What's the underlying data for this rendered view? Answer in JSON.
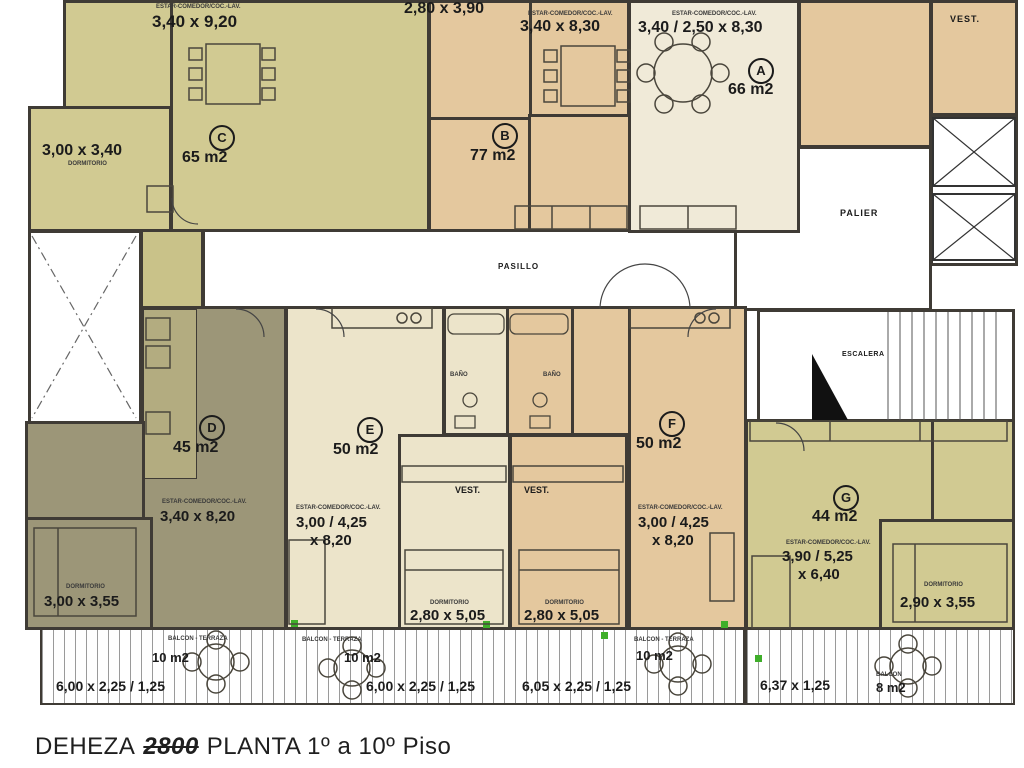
{
  "title": {
    "street": "DEHEZA",
    "number": "2800",
    "rest": "PLANTA 1º a 10º Piso"
  },
  "units": [
    {
      "letter": "A",
      "area": "66 m2",
      "living": "3,40 / 2,50 x 8,30"
    },
    {
      "letter": "B",
      "area": "77 m2",
      "living": "3,40 x 8,30",
      "bedroom": "2,80 x 3,90"
    },
    {
      "letter": "C",
      "area": "65 m2",
      "living": "3,40 x 9,20",
      "bedroom": "3,00 x 3,40"
    },
    {
      "letter": "D",
      "area": "45 m2",
      "living": "3,40 x 8,20",
      "bedroom": "3,00 x 3,55"
    },
    {
      "letter": "E",
      "area": "50 m2",
      "living1": "3,00 / 4,25",
      "living2": "x 8,20",
      "bedroom": "2,80 x 5,05"
    },
    {
      "letter": "F",
      "area": "50 m2",
      "living1": "3,00 / 4,25",
      "living2": "x 8,20",
      "bedroom": "2,80 x 5,05"
    },
    {
      "letter": "G",
      "area": "44 m2",
      "living1": "3,90 / 5,25",
      "living2": "x 6,40",
      "bedroom": "2,90 x 3,55"
    }
  ],
  "common": {
    "pasillo": "PASILLO",
    "palier": "PALIER",
    "escalera": "ESCALERA",
    "vest": "VEST.",
    "bano": "BAÑO",
    "dormitorio": "DORMITORIO",
    "estar": "ESTAR-COMEDOR/COC.-LAV.",
    "balcon_terraza": "BALCON - TERRAZA",
    "balcon": "BALCON"
  },
  "balconies": [
    {
      "area": "10 m2",
      "dim": "6,00 x 2,25 / 1,25"
    },
    {
      "area": "10 m2",
      "dim": "6,00 x 2,25 / 1,25"
    },
    {
      "area": "10 m2",
      "dim": "6,05 x 2,25 / 1,25"
    },
    {
      "area": "8 m2",
      "dim": "6,37 x 1,25"
    }
  ],
  "colors": {
    "khaki": "#d1ca92",
    "tan": "#e4c89e",
    "cream": "#f0ead8",
    "cream_light": "#ece4ca",
    "olive": "#9c9678",
    "wall": "#3f3b35",
    "accent_green": "#3fae2a"
  }
}
